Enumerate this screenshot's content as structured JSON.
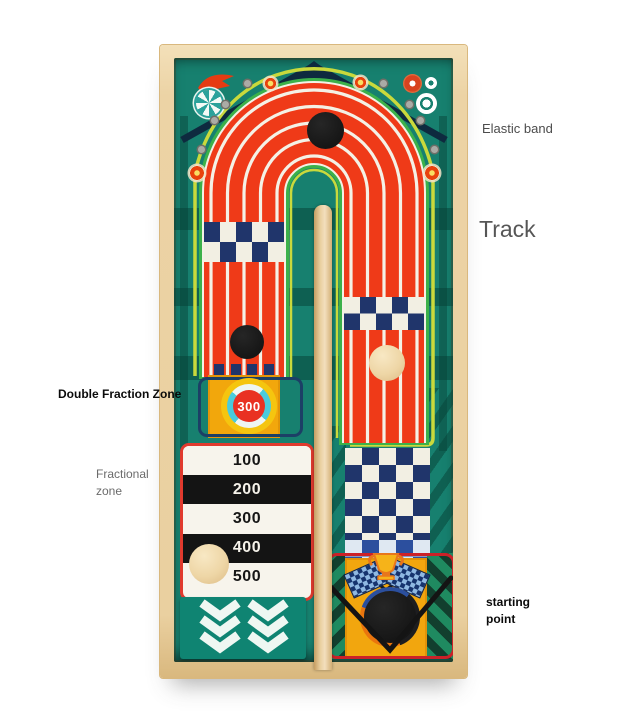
{
  "annotations": {
    "elastic_band": "Elastic band",
    "track": "Track",
    "double_fraction_zone": "Double Fraction Zone",
    "fractional_zone_line1": "Fractional",
    "fractional_zone_line2": "zone",
    "starting_point_line1": "starting",
    "starting_point_line2": "point"
  },
  "board": {
    "target_value": "300",
    "fraction_rows": [
      {
        "value": "100",
        "bg": "white"
      },
      {
        "value": "200",
        "bg": "black"
      },
      {
        "value": "300",
        "bg": "white"
      },
      {
        "value": "400",
        "bg": "black"
      },
      {
        "value": "500",
        "bg": "white"
      }
    ],
    "icons": [
      "comet-icon",
      "pinwheel-candy-icon",
      "candy-icon",
      "flower-icon",
      "ring-dot-icon",
      "double-ring-icon",
      "trophy-icon",
      "checkered-flag-icon",
      "chevron-down-icon"
    ],
    "colors": {
      "wood_frame": "#ecd3a5",
      "board_teal": "#17806f",
      "track_red": "#ef3a18",
      "elastic_band_yellow": "#c9d93c",
      "track_outline_green": "#3cb14a",
      "checker_navy": "#20356b",
      "zone_yellow": "#f2a70c",
      "target_red": "#e93122",
      "target_cyan": "#49cbdc",
      "fraction_border_red": "#e03a2e",
      "start_outline_red": "#cc2128"
    }
  }
}
